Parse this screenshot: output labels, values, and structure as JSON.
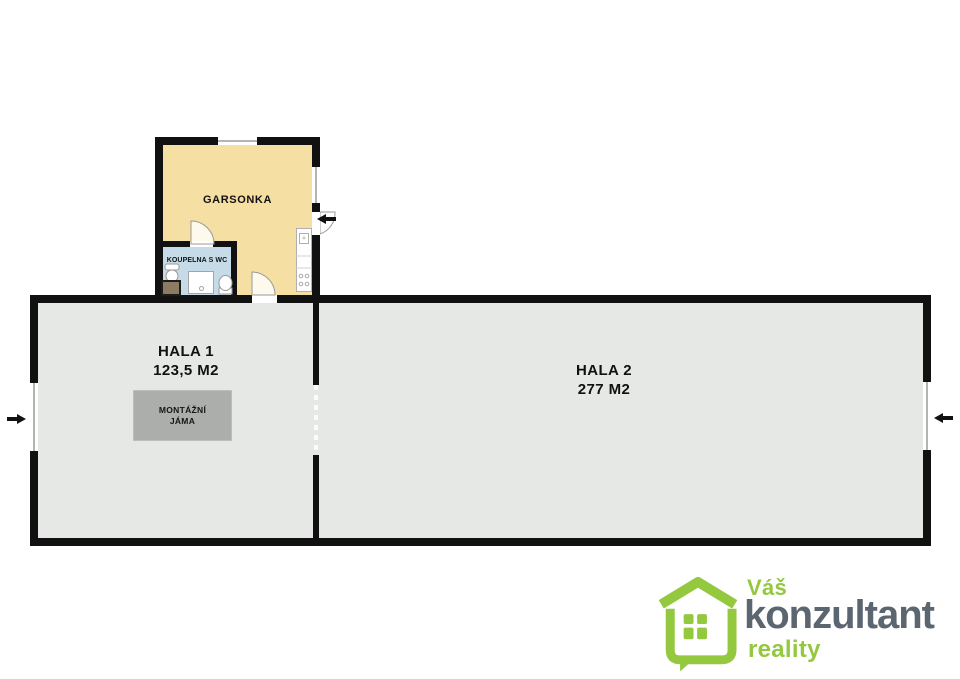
{
  "rooms": {
    "garsonka": {
      "label": "GARSONKA"
    },
    "koupelna": {
      "label": "KOUPELNA S WC"
    },
    "hala1": {
      "label": "HALA 1",
      "area": "123,5 M2"
    },
    "hala2": {
      "label": "HALA 2",
      "area": "277 M2"
    }
  },
  "features": {
    "pit": {
      "line1": "MONTÁŽNÍ",
      "line2": "JÁMA"
    }
  },
  "logo": {
    "top": "Váš",
    "name": "konzultant",
    "bottom": "reality"
  },
  "colors": {
    "wall": "#111111",
    "hall_floor": "#E5E8E5",
    "garsonka_floor": "#F6DFA3",
    "bathroom_floor": "#C6DBE8",
    "pit_fill": "#ABAEAB",
    "logo_green": "#94C83E",
    "logo_gray": "#5B6670"
  }
}
